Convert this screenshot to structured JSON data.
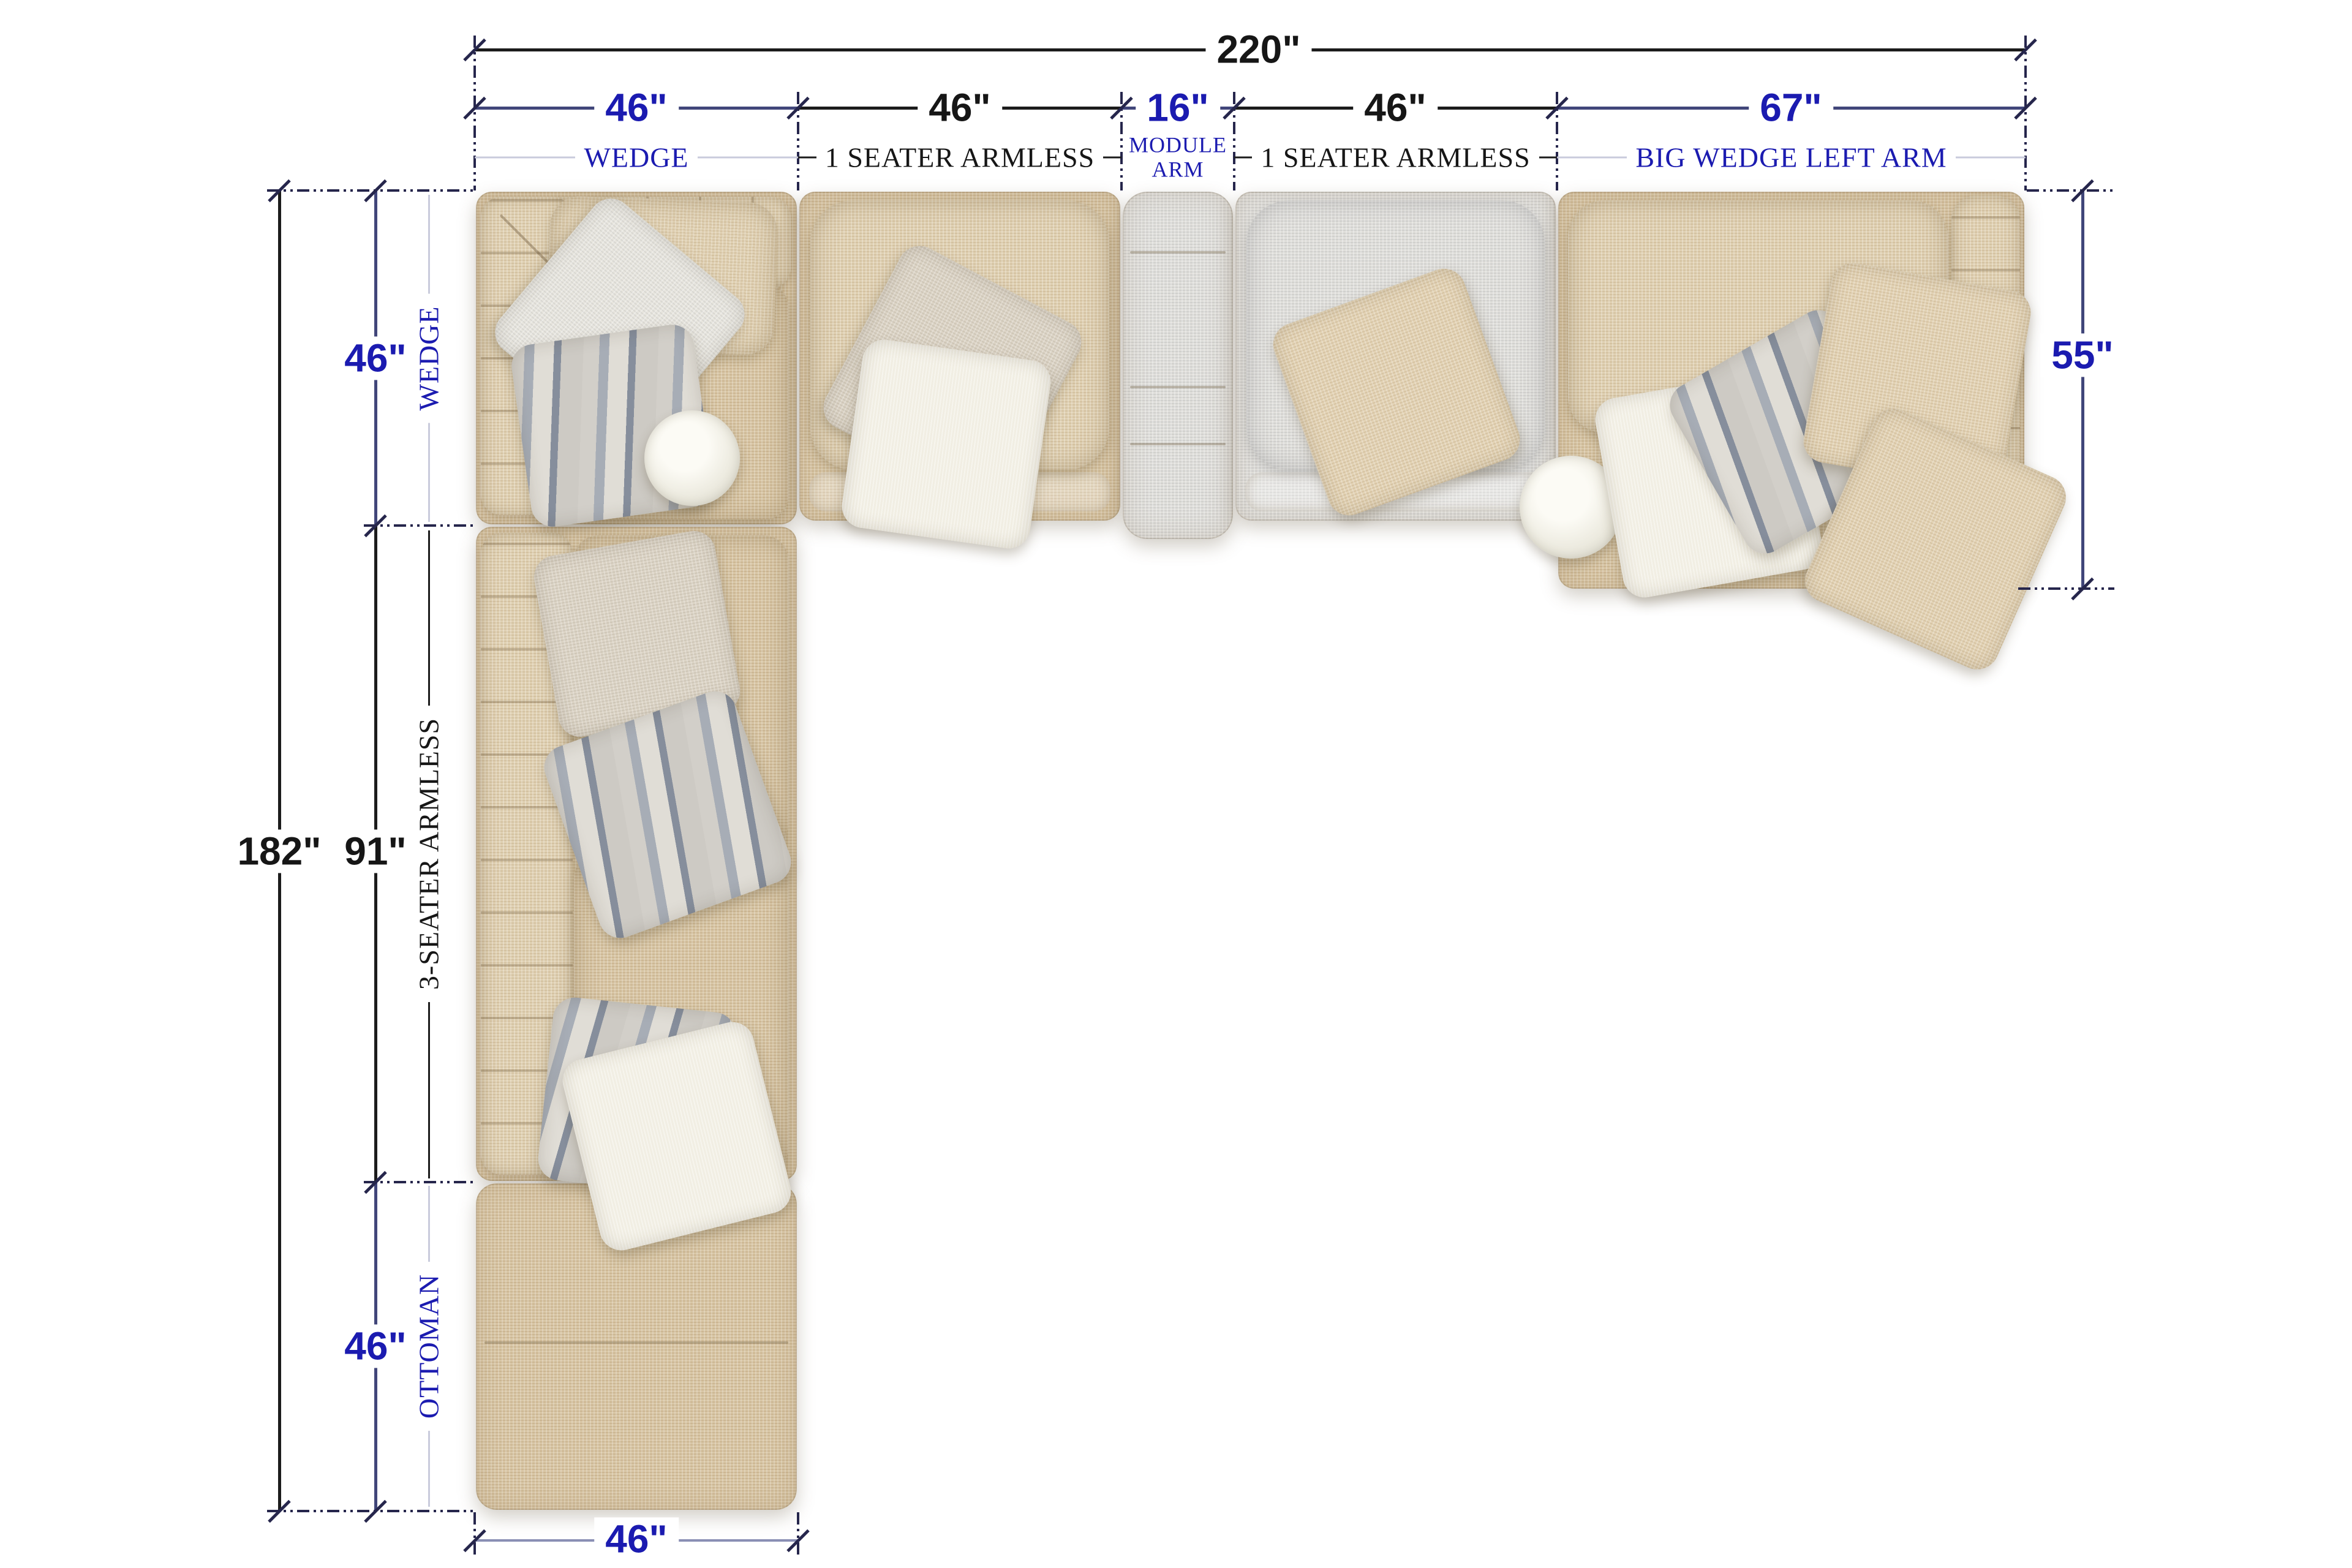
{
  "title": "Sectional sofa top-view dimension diagram",
  "units": "inches",
  "overall": {
    "top_width": "220\"",
    "left_height": "182\"",
    "left_mid": "91\"",
    "right_depth": "55\"",
    "bottom_width": "46\""
  },
  "top_row": {
    "segments": [
      {
        "dim": "46\"",
        "label": "WEDGE",
        "accent": "blue"
      },
      {
        "dim": "46\"",
        "label": "1 SEATER ARMLESS",
        "accent": "black"
      },
      {
        "dim": "16\"",
        "label": "MODULE ARM",
        "accent": "blue"
      },
      {
        "dim": "46\"",
        "label": "1 SEATER ARMLESS",
        "accent": "black"
      },
      {
        "dim": "67\"",
        "label": "BIG WEDGE  LEFT ARM",
        "accent": "blue"
      }
    ]
  },
  "left_col": {
    "segments": [
      {
        "dim": "46\"",
        "label": "WEDGE",
        "accent": "blue"
      },
      {
        "dim": "91\"",
        "label": "3-SEATER ARMLESS",
        "accent": "black"
      },
      {
        "dim": "46\"",
        "label": "OTTOMAN",
        "accent": "blue"
      }
    ]
  },
  "colors": {
    "accent_blue": "#1b1bb0",
    "text_black": "#161616",
    "dim_line_navy": "#41467a",
    "dim_line_black": "#1c1c1c",
    "extension_navy": "#26264c",
    "leader_gray": "#c9cbdc",
    "fabric_beige": "#d9c7a6",
    "fabric_gray": "#e0dfdb",
    "pillow_white": "#f1eee3",
    "stripe_gray": "#868e9c"
  }
}
